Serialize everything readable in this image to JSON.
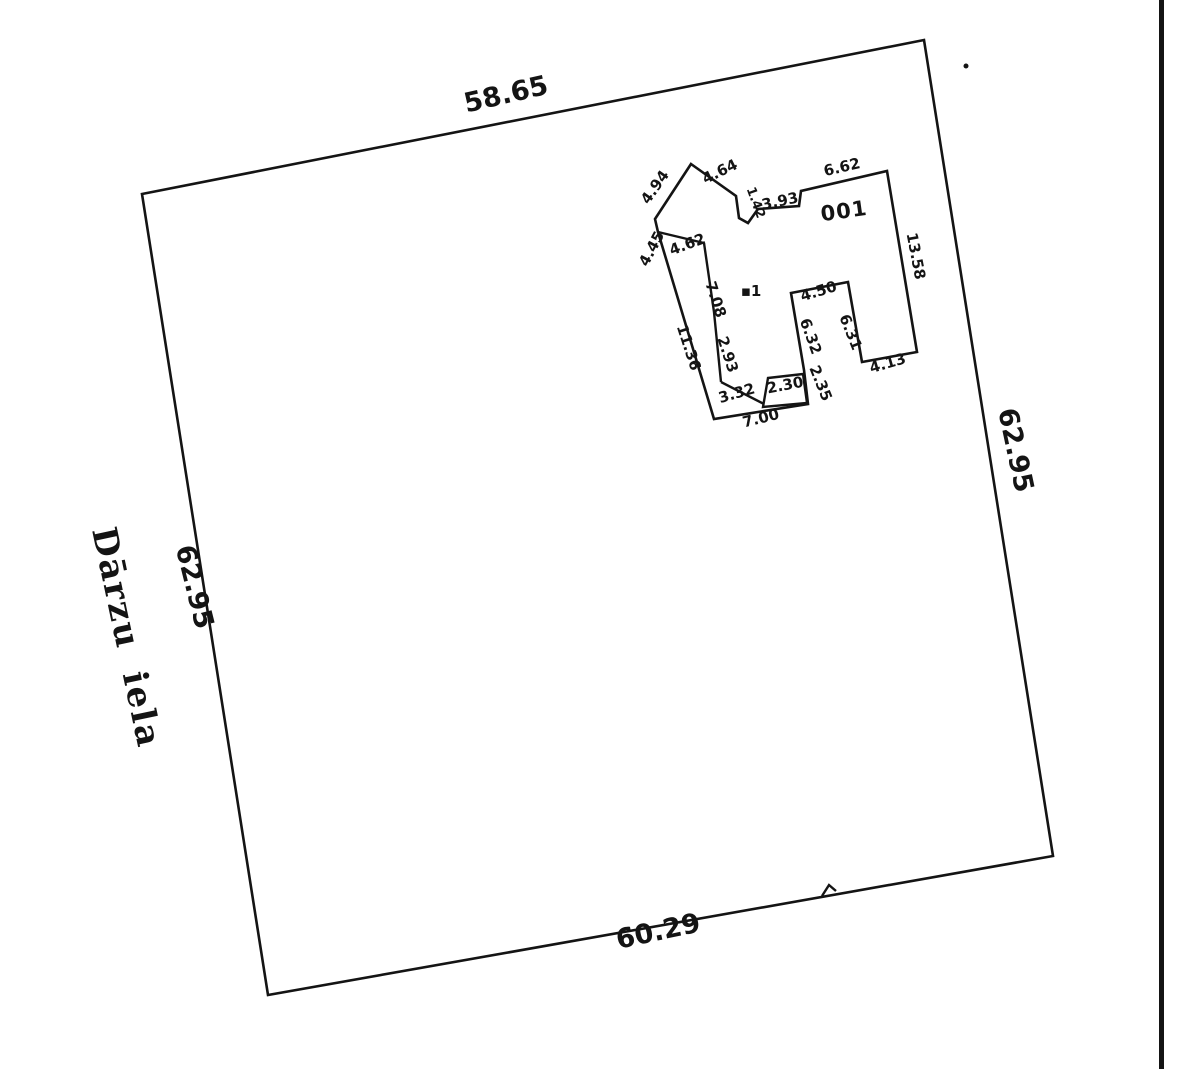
{
  "document": {
    "type_label": "cadastral parcel plan",
    "ink_color": "#141414",
    "paper_color": "#ffffff"
  },
  "street": {
    "name": "Dārzu iela"
  },
  "parcel": {
    "side_lengths": {
      "top": "58.65",
      "right": "62.95",
      "bottom": "60.29",
      "left": "62.95"
    }
  },
  "building": {
    "cadastral_number": "001",
    "unit_marker": "▪1",
    "dimensions": {
      "d_4_64": "4.64",
      "d_4_94": "4.94",
      "d_4_45": "4.45",
      "d_4_62": "4.62",
      "d_11_36": "11.36",
      "d_7_08": "7.08",
      "d_2_93": "2.93",
      "d_3_32": "3.32",
      "d_7_00": "7.00",
      "d_2_30": "2.30",
      "d_2_35": "2.35",
      "d_6_32": "6.32",
      "d_4_50": "4.50",
      "d_6_31": "6.31",
      "d_4_13": "4.13",
      "d_13_58": "13.58",
      "d_6_62": "6.62",
      "d_1_42": "1.42",
      "d_3_93": "3.93"
    }
  }
}
